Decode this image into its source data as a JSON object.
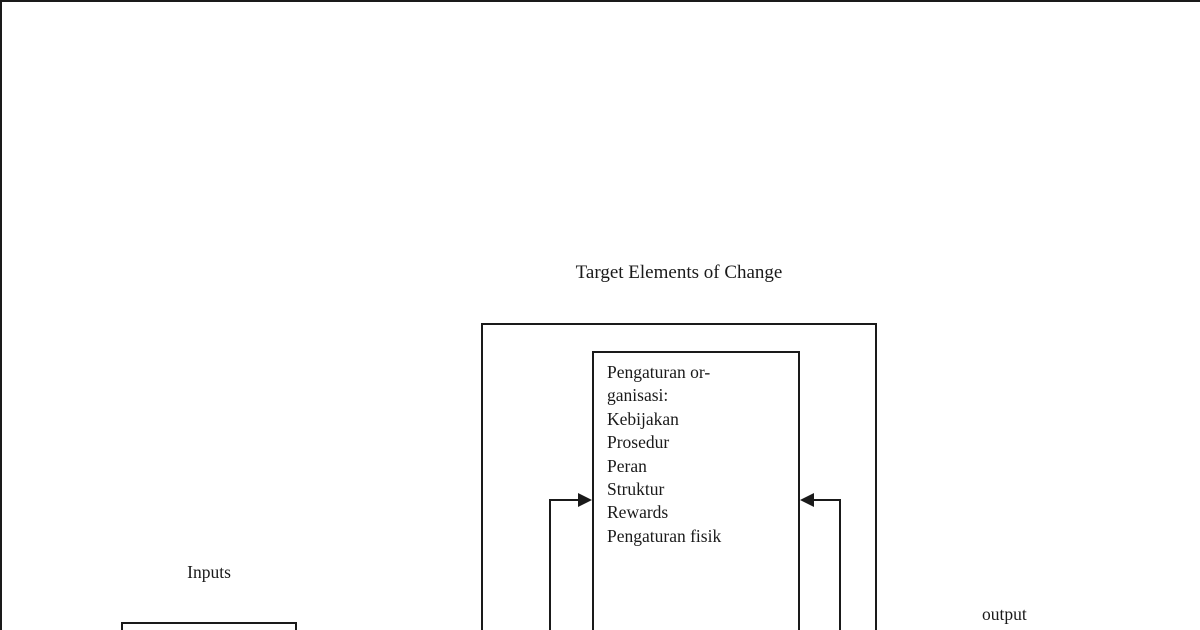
{
  "diagram": {
    "title": "Target Elements of Change",
    "labels": {
      "inputs": "Inputs",
      "output": "output"
    },
    "inner_box": {
      "lines": [
        "Pengaturan or-",
        "ganisasi:",
        "Kebijakan",
        "Prosedur",
        "Peran",
        "Struktur",
        "Rewards",
        "Pengaturan fisik"
      ]
    },
    "colors": {
      "line": "#1a1a1a",
      "text": "#1a1a1a",
      "background": "#ffffff"
    }
  }
}
